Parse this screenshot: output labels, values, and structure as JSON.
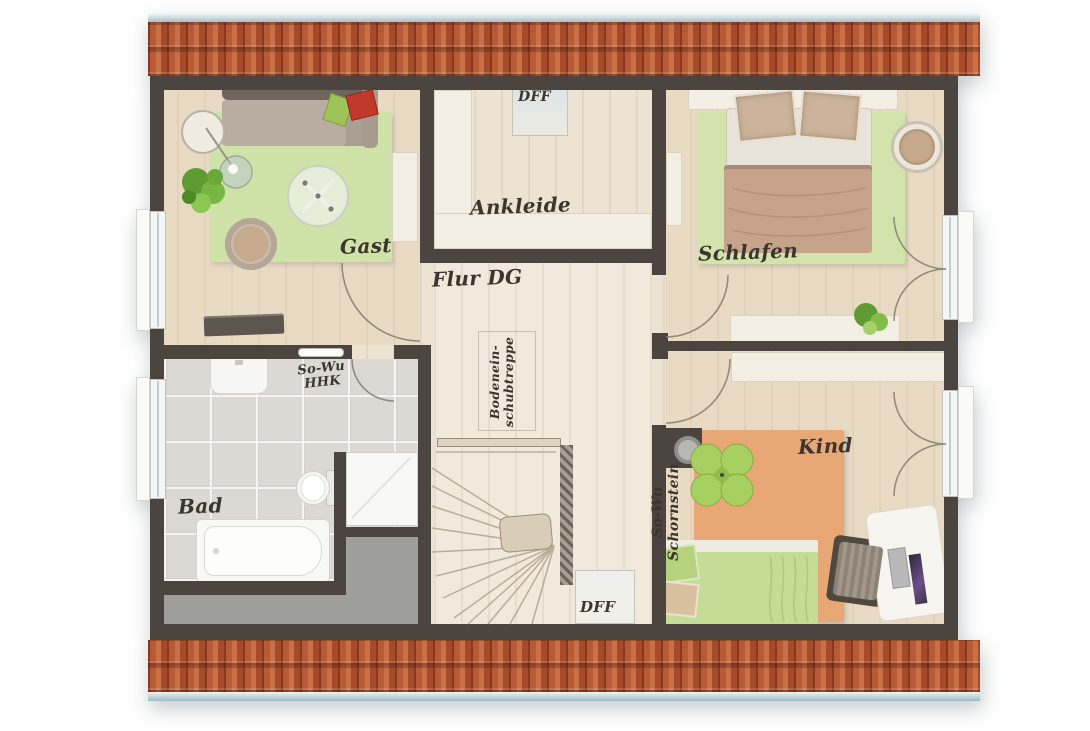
{
  "plan_type": "attic floor plan (Dachgeschoss)",
  "labels": {
    "gast": "Gast",
    "ankleide": "Ankleide",
    "schlafen": "Schlafen",
    "flur": "Flur DG",
    "bad": "Bad",
    "kind": "Kind",
    "dff_top": "DFF",
    "dff_bottom": "DFF",
    "sowu_hhk": {
      "line1": "So-Wu",
      "line2": "HHK"
    },
    "sowu_schornstein": {
      "line1": "So-Wu",
      "line2": "Schornstein"
    },
    "bodentreppe": {
      "line1": "Bodenein-",
      "line2": "schubtreppe"
    }
  },
  "colors": {
    "wall": "#4c443e",
    "wood_floor": "#ece3d2",
    "flur_floor": "#f1eadc",
    "bath_tile": "#dcd9d5",
    "storage_gray": "#9e9e9b",
    "rug_green": "#cfe2a8",
    "rug_orange": "#e7a876",
    "duvet_tan": "#c5a48b",
    "duvet_green": "#c3dc96",
    "roof_tile": "#b0522e",
    "ridge_blue": "#9fb9c1",
    "label_ink": "#3b352d",
    "white_furniture": "#f3efe4"
  }
}
